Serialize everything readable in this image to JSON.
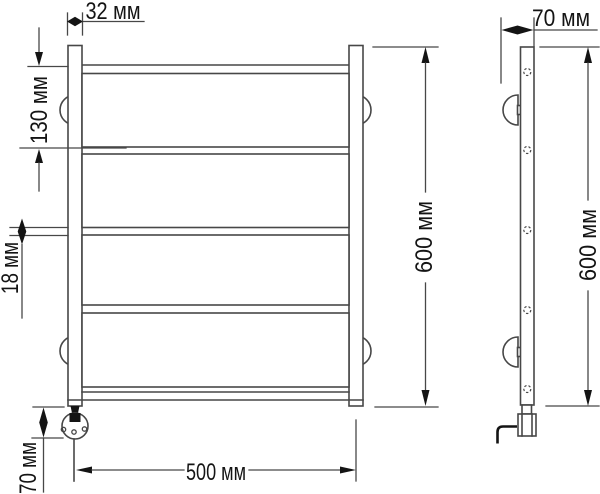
{
  "colors": {
    "background": "#ffffff",
    "line": "#474747",
    "ink": "#141414"
  },
  "drawing": {
    "type": "technical-drawing",
    "subject": "ladder towel rail, front and side views with dimensions",
    "front_view": {
      "rung_count": 4,
      "bracket_count": 4,
      "dims": {
        "tube_width": "32 мм",
        "top_section": "130 мм",
        "rung_gap": "18 мм",
        "heater": "70 мм",
        "overall_width": "500 мм",
        "overall_height": "600 мм"
      }
    },
    "side_view": {
      "mount_hole_count": 5,
      "bracket_count": 2,
      "dims": {
        "depth": "70 мм",
        "overall_height": "600 мм"
      }
    }
  }
}
